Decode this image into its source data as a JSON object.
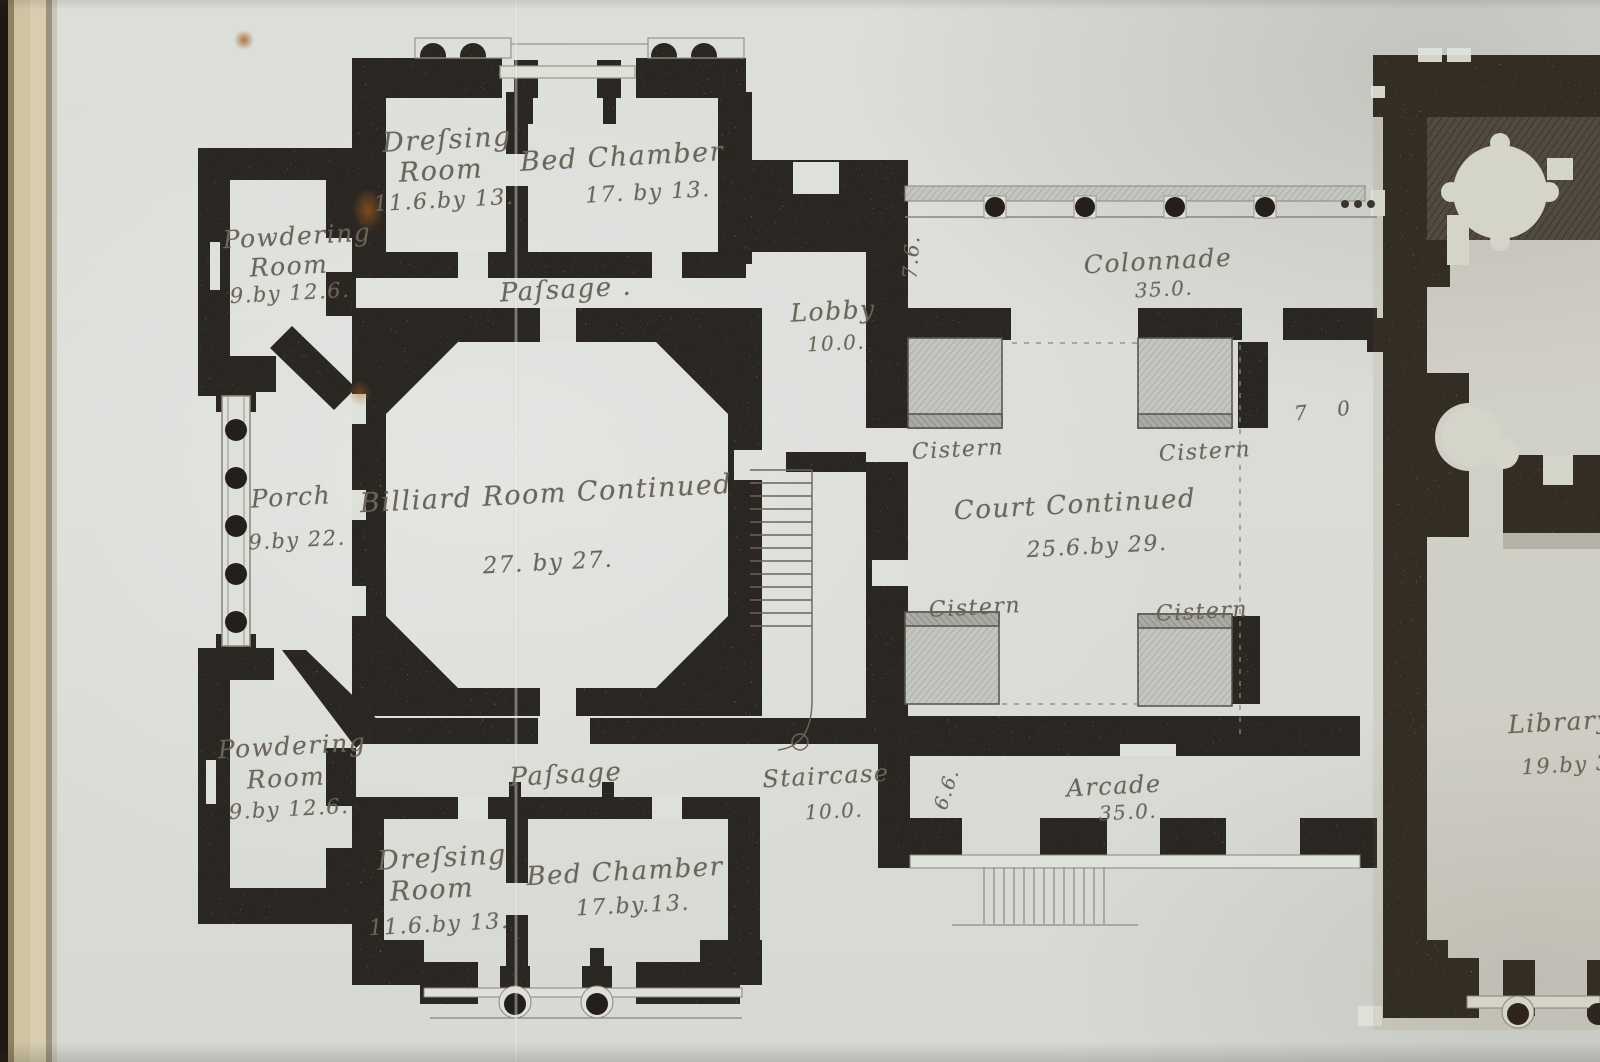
{
  "plan": {
    "title_hint": "Engraved country-house floor plan (framed print, left sheet edge visible)",
    "rooms": {
      "dressing_room_top": {
        "name_l1": "Dreſsing",
        "name_l2": "Room",
        "dim": "11.6.by 13."
      },
      "bed_chamber_top": {
        "name": "Bed Chamber",
        "dim": "17. by 13."
      },
      "powdering_room_top": {
        "name_l1": "Powdering",
        "name_l2": "Room",
        "dim": "9.by 12.6."
      },
      "passage_top": {
        "name": "Paſsage ."
      },
      "lobby": {
        "name": "Lobby",
        "dim": "10.0."
      },
      "colonnade": {
        "name": "Colonnade",
        "dim": "35.0."
      },
      "porch": {
        "name": "Porch",
        "dim": "9.by 22."
      },
      "billiard_room": {
        "name": "Billiard Room Continued",
        "dim": "27. by 27."
      },
      "court": {
        "name": "Court Continued",
        "dim": "25.6.by 29."
      },
      "cistern_tl": {
        "name": "Cistern"
      },
      "cistern_tr": {
        "name": "Cistern"
      },
      "cistern_bl": {
        "name": "Cistern"
      },
      "cistern_br": {
        "name": "Cistern"
      },
      "staircase": {
        "name": "Staircase",
        "dim": "10.0."
      },
      "passage_bottom": {
        "name": "Paſsage"
      },
      "arcade": {
        "name": "Arcade",
        "dim": "35.0."
      },
      "powdering_room_bottom": {
        "name_l1": "Powdering",
        "name_l2": "Room",
        "dim": "9.by 12.6."
      },
      "dressing_room_bottom": {
        "name_l1": "Dreſsing",
        "name_l2": "Room",
        "dim": "11.6.by 13."
      },
      "bed_chamber_bottom": {
        "name": "Bed Chamber",
        "dim": "17.by.13."
      },
      "library": {
        "name": "Library",
        "dim": "19.by 3"
      }
    },
    "annotations": {
      "colonnade_depth": "7.6.",
      "court_offset": "7 0",
      "arcade_depth": "6.6."
    },
    "colors": {
      "paper": "#dee0da",
      "wall_ink": "#2a2520",
      "script_ink": "#6b6458",
      "frame_mat": "#d3c7a6",
      "stain": "#b5641f"
    }
  }
}
